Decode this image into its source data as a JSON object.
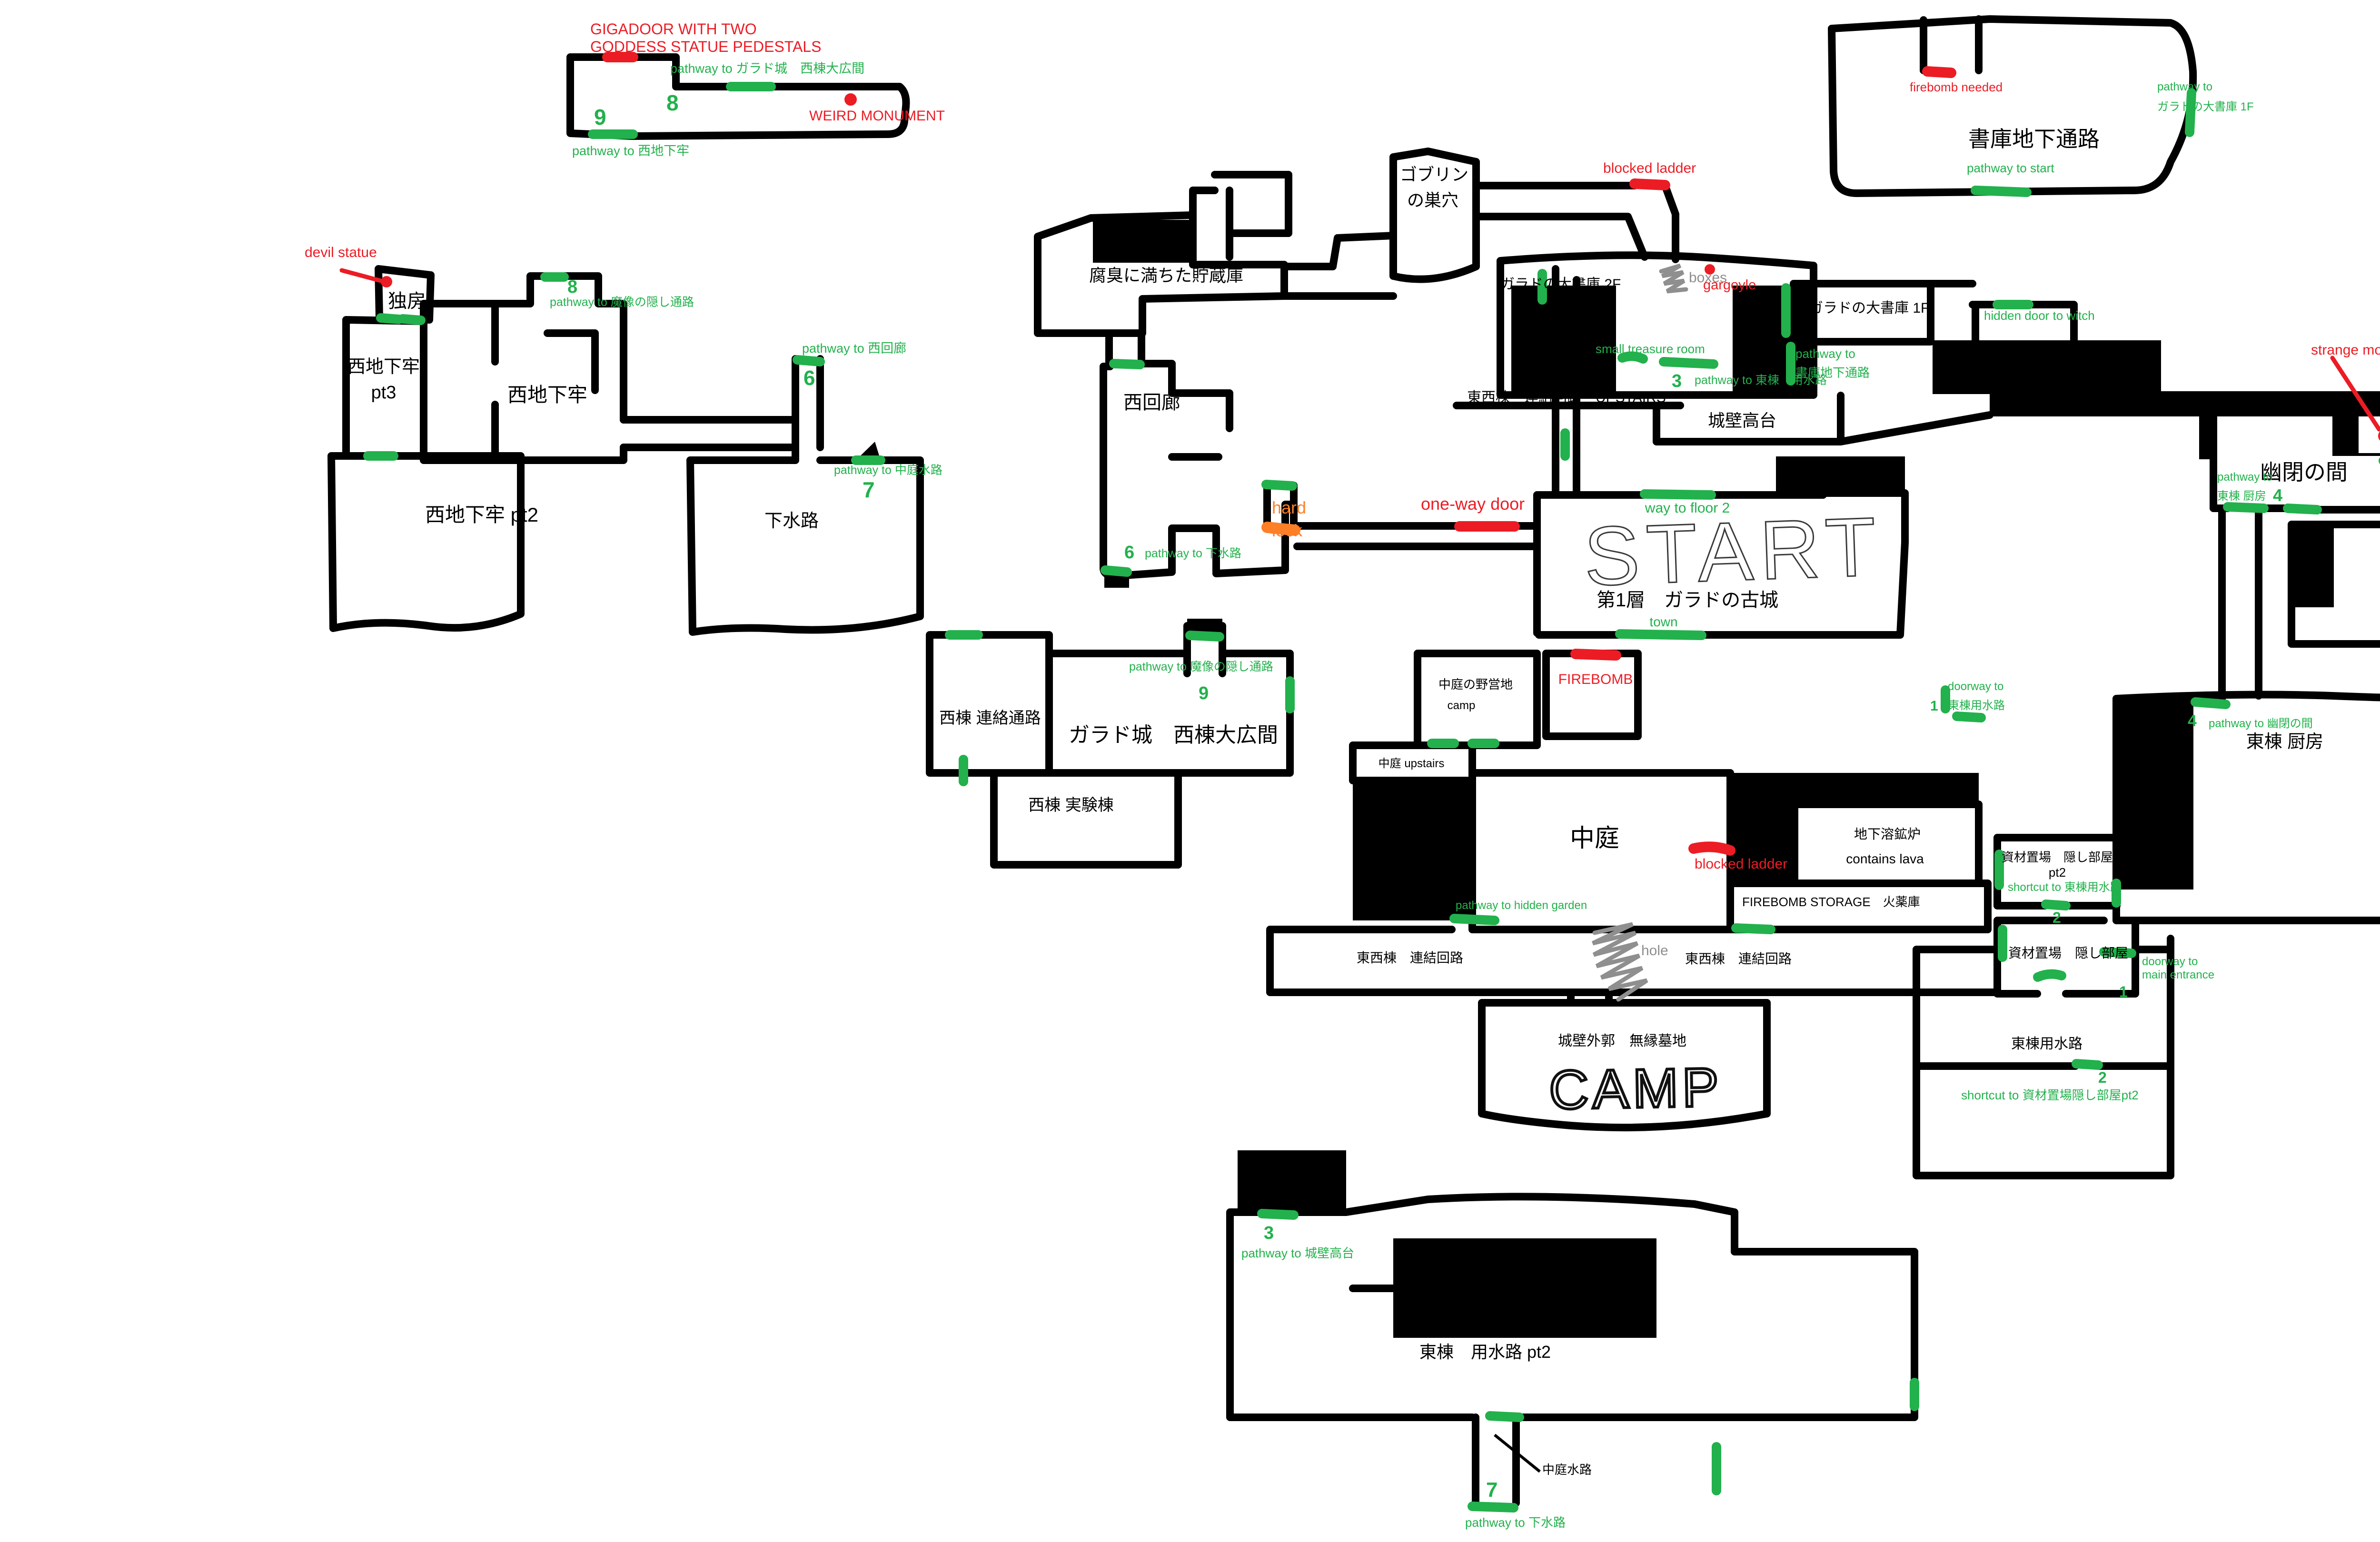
{
  "colors": {
    "wall": "#000000",
    "pathway_green": "#22b14c",
    "blocked_red": "#ec1c24",
    "hardlock_orange": "#ff7f27",
    "water_blue": "#45aef5",
    "note_gray": "#8f8f8f"
  },
  "labels": {
    "gigadoor1": "GIGADOOR WITH TWO",
    "gigadoor2": "GODDESS STATUE PEDESTALS",
    "p_garado_west_hall": "pathway to ガラド城　西棟大広間",
    "n8a": "8",
    "n9a": "9",
    "n8b": "8",
    "n9b": "9",
    "p_west_dungeon": "pathway to 西地下牢",
    "weird_monument": "WEIRD MONUMENT",
    "devil_statue": "devil statue",
    "dokubou": "独房",
    "west_dungeon_l1": "西地下牢",
    "west_dungeon_l2": "pt3",
    "west_dungeon_mid": "西地下牢",
    "west_dungeon_pt2": "西地下牢 pt2",
    "gesuiro": "下水路",
    "p_mazou1": "pathway to 魔像の隠し通路",
    "p_mazou2": "pathway to 魔像の隠し通路",
    "p_west_corridor": "pathway to 西回廊",
    "n6a": "6",
    "n6b": "6",
    "p_nakaniwa_suiro": "pathway to 中庭水路",
    "n7a": "7",
    "n7b": "7",
    "fushu": "腐臭に満ちた貯蔵庫",
    "goblin1": "ゴブリン",
    "goblin2": "の巣穴",
    "blocked_ladder1": "blocked ladder",
    "lib2f": "ガラドの大書庫 2F",
    "boxes": "boxes",
    "gargoyle": "gargoyle",
    "small_treasure": "small treasure room",
    "upstairs_label": "東西棟　連結回路　UPSTAIRS",
    "johekitakadai": "城壁高台",
    "n3a": "3",
    "n3b": "3",
    "p_east_yosuiro": "pathway to 東棟　用水路",
    "lib1f": "ガラドの大書庫 1F",
    "hidden_witch": "hidden door to witch",
    "p_shoko_chika1": "pathway to",
    "p_shoko_chika2": "書庫地下通路",
    "shoko_chika": "書庫地下通路",
    "firebomb_needed": "firebomb needed",
    "p_lib1f_a1": "pathway to",
    "p_lib1f_a2": "ガラドの大書庫 1F",
    "p_start": "pathway to start",
    "strange_monument": "strange monument",
    "yuhei": "幽閉の間",
    "p_kitchen1": "pathway to",
    "p_kitchen2": "東棟 厨房",
    "n4a": "4",
    "n4b": "4",
    "n5a": "5",
    "n5b": "5",
    "p_garden1": "pathway to",
    "p_garden2": "書庫前の庭園",
    "east_corridor": "東回廊",
    "p_lib1f_b1": "pathway to",
    "p_lib1f_b2": "ガラドの大書庫 1F",
    "garden": "書庫前の庭園",
    "east_camp_area": "城壁外郭 東の野営地",
    "camp_east": "CAMP",
    "west_renraku": "西棟 連絡通路",
    "garado_hall": "ガラド城　西棟大広間",
    "west_jikken": "西棟 実験棟",
    "west_corridor": "西回廊",
    "p_gesuiro2": "pathway to 下水路",
    "nakaniwa_camp1": "中庭の野営地",
    "nakaniwa_camp2": "camp",
    "firebomb": "FIREBOMB",
    "nakaniwa_upstairs": "中庭 upstairs",
    "nakaniwa": "中庭",
    "doorway_east1": "doorway to",
    "doorway_east2": "東棟用水路",
    "n1a": "1",
    "n1b": "1",
    "chika_yokoro1": "地下溶鉱炉",
    "chika_yokoro2": "contains lava",
    "blocked_ladder2": "blocked ladder",
    "shizai_pt2_1": "資材置場　隠し部屋",
    "shizai_pt2_2": "pt2",
    "shortcut_east_yosuiro": "shortcut to 東棟用水路",
    "n2a": "2",
    "n2b": "2",
    "shizai1": "資材置場　隠し部屋",
    "doorway_main1": "doorway to",
    "doorway_main2": "main entrance",
    "east_yosuiro": "東棟用水路",
    "shortcut_shizai": "shortcut to 資材置場隠し部屋pt2",
    "firebomb_storage": "FIREBOMB STORAGE　火薬庫",
    "renketsu_left": "東西棟　連結回路",
    "hole": "hole",
    "renketsu_right": "東西棟　連結回路",
    "p_hidden_garden": "pathway to hidden garden",
    "muen_bochi": "城壁外郭　無縁墓地",
    "camp_center": "CAMP",
    "p_joheki": "pathway to 城壁高台",
    "east_yosuiro_pt2": "東棟　用水路 pt2",
    "nakaniwa_suiro": "中庭水路",
    "p_gesuiro": "pathway to 下水路",
    "start": "START",
    "way_floor2": "way to floor 2",
    "floor1": "第1層　ガラドの古城",
    "town": "town",
    "hard1": "hard",
    "hard2": "lock",
    "oneway": "one-way door",
    "kitchen": "東棟 厨房",
    "p_yuhei": "pathway to 幽閉の間"
  }
}
